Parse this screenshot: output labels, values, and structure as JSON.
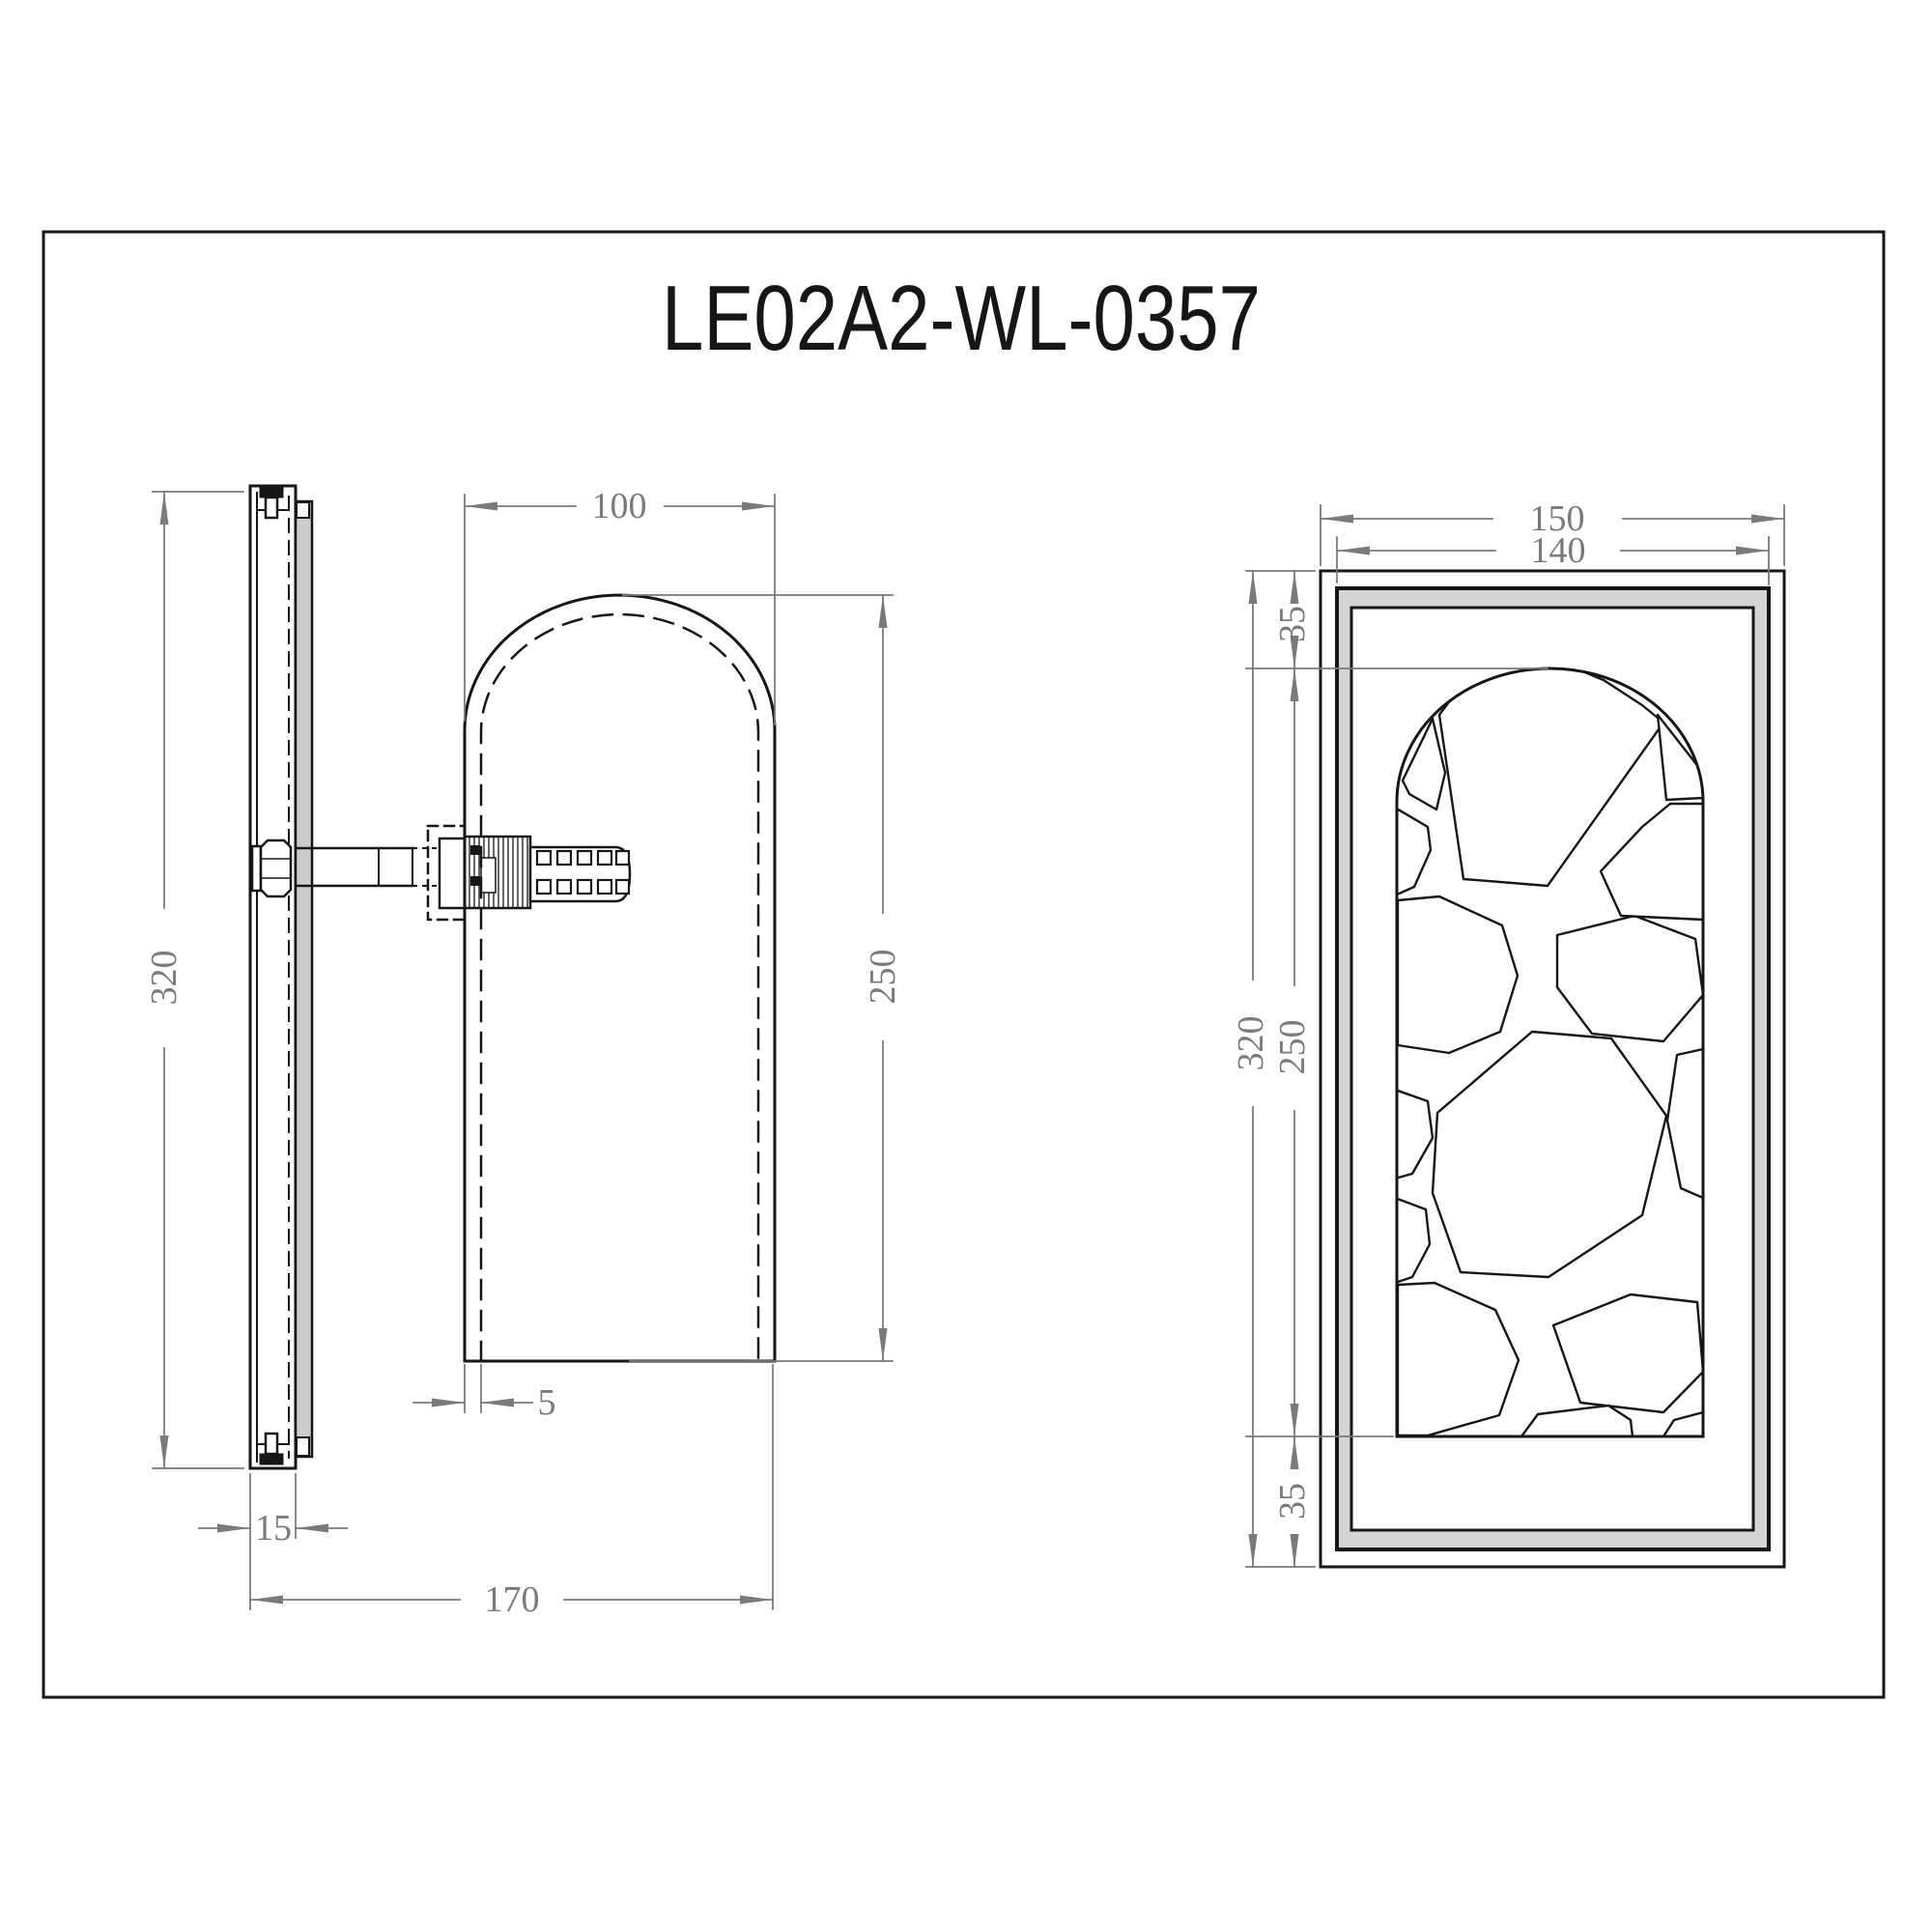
{
  "title_block": {
    "model_number": "LE02A2-WL-0357"
  },
  "colors": {
    "object_line": "#161616",
    "dimension_line": "#7a7a7a",
    "back_panel_gray": "#cccccc",
    "frame_band_gray": "#d4d4d4"
  },
  "side_view": {
    "label": "side profile view",
    "dimensions": {
      "overall_height": "320",
      "shade_width": "100",
      "shade_height": "250",
      "shade_wall_thickness": "5",
      "backplate_depth": "15",
      "overall_depth": "170"
    }
  },
  "front_view": {
    "label": "front view",
    "dimensions": {
      "overall_width": "150",
      "inner_width": "140",
      "top_margin": "35",
      "overall_height": "320",
      "window_height": "250",
      "bottom_margin": "35"
    }
  }
}
